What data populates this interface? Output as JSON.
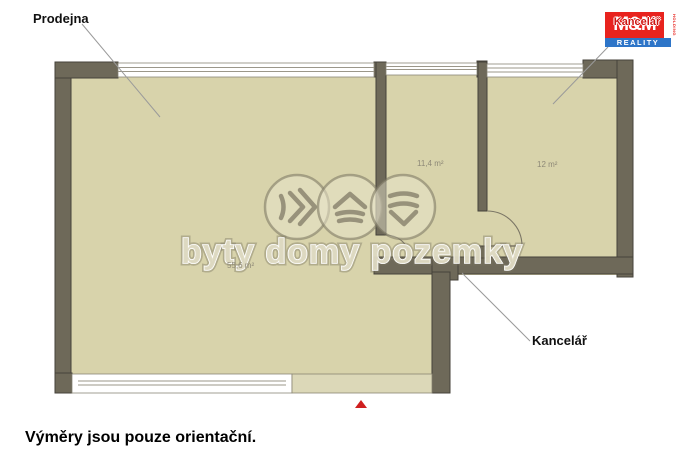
{
  "plan": {
    "room_labels": {
      "prodejna": "Prodejna",
      "kancelar": "Kancelář"
    },
    "areas": {
      "prodejna": "55,6 m²",
      "middle_room": "11,4 m²",
      "right_room": "12 m²"
    }
  },
  "watermark": {
    "text": "byty domy pozemky"
  },
  "logo": {
    "kancelar": "Kancelář",
    "mm": "M&M",
    "reality": "REALITY",
    "holding": "HOLDING"
  },
  "footer": {
    "disclaimer": "Výměry jsou pouze orientační."
  },
  "colors": {
    "room_fill": "#d8d3ab",
    "wall": "#6e6959",
    "light_wall": "#dcd8b8",
    "logo_red": "#e8231e",
    "logo_blue": "#2e75c8",
    "marker_red": "#cf1f1f"
  }
}
